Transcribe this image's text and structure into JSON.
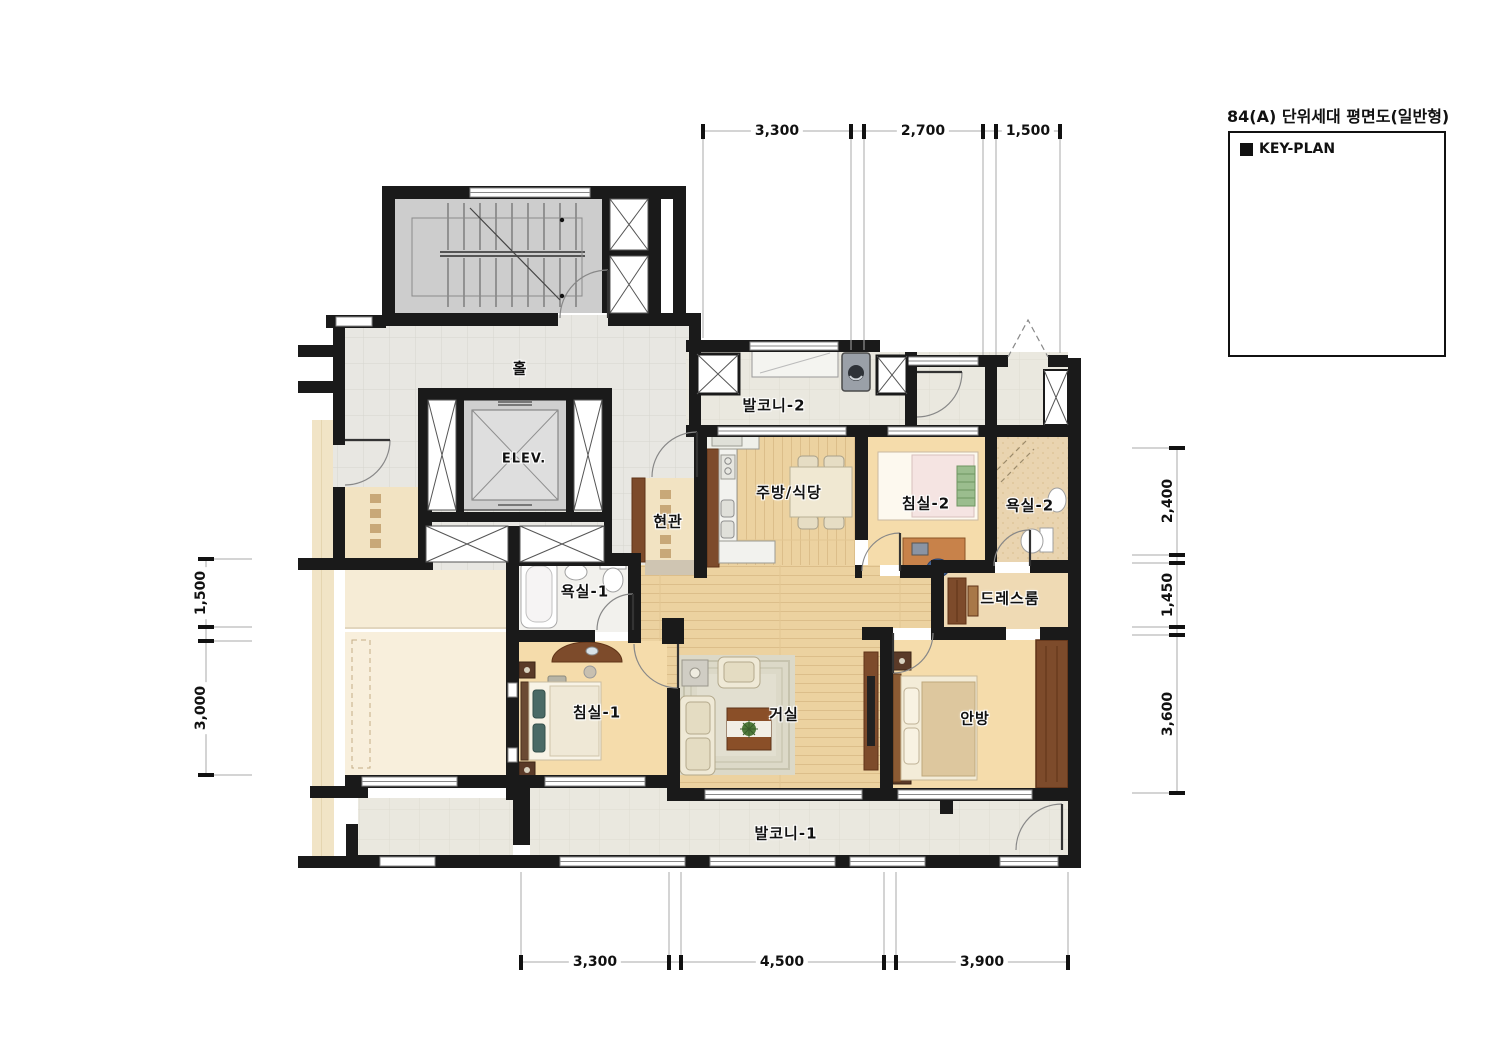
{
  "title": "84(A) 단위세대 평면도(일반형)",
  "key_plan": {
    "label": "KEY-PLAN"
  },
  "rooms": {
    "hall": "홀",
    "elevator": "ELEV.",
    "entrance": "현관",
    "balcony2": "발코니-2",
    "kitchen_dining": "주방/식당",
    "bedroom2": "침실-2",
    "bathroom2": "욕실-2",
    "bathroom1": "욕실-1",
    "dressroom": "드레스룸",
    "bedroom1": "침실-1",
    "living": "거실",
    "master_bedroom": "안방",
    "balcony1": "발코니-1"
  },
  "dimensions": {
    "top": [
      "3,300",
      "2,700",
      "1,500"
    ],
    "bottom": [
      "3,300",
      "4,500",
      "3,900"
    ],
    "left": [
      "1,500",
      "3,000"
    ],
    "right": [
      "2,400",
      "1,450",
      "3,600"
    ]
  },
  "colors": {
    "wall": "#1a1a1a",
    "wood_floor": "#ecd2a0",
    "bedroom_floor": "#f5dcab",
    "hall_tile": "#e8e7e2",
    "balcony_floor": "#eae8df",
    "bath_tile": "#e9d4b0",
    "cabinet_brown": "#7d4b2b",
    "stair_fill": "#cdcdcd"
  }
}
